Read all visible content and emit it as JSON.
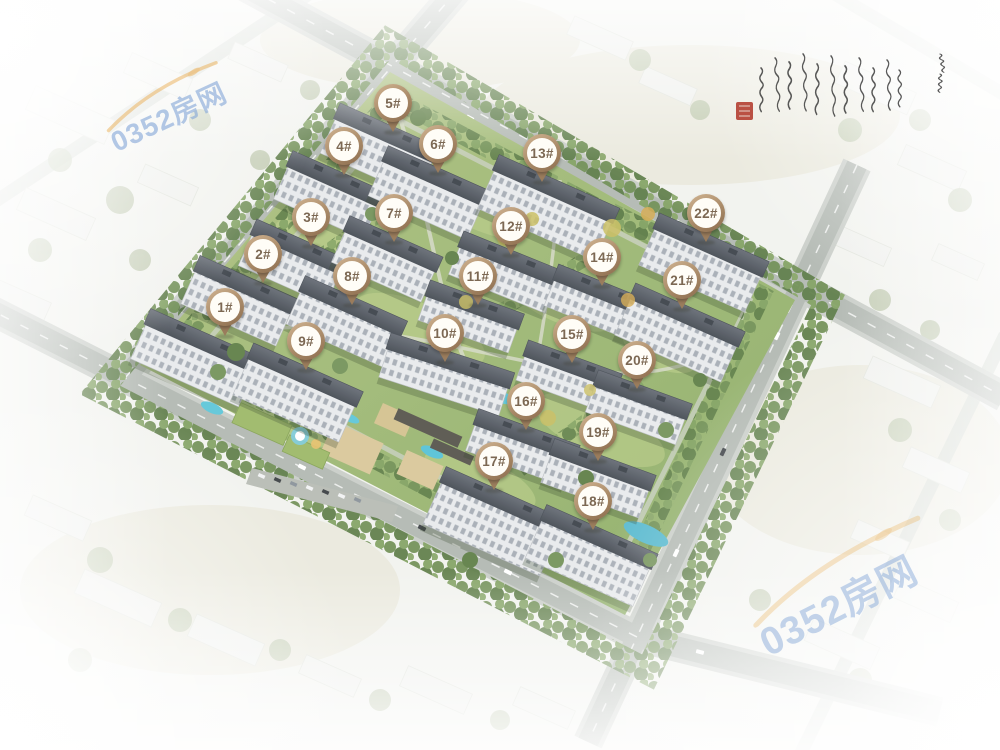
{
  "markers": {
    "items": [
      {
        "label": "1#",
        "x": 225,
        "y": 307
      },
      {
        "label": "2#",
        "x": 263,
        "y": 254
      },
      {
        "label": "3#",
        "x": 311,
        "y": 217
      },
      {
        "label": "4#",
        "x": 344,
        "y": 146
      },
      {
        "label": "5#",
        "x": 393,
        "y": 103
      },
      {
        "label": "6#",
        "x": 438,
        "y": 144
      },
      {
        "label": "7#",
        "x": 394,
        "y": 213
      },
      {
        "label": "8#",
        "x": 352,
        "y": 276
      },
      {
        "label": "9#",
        "x": 306,
        "y": 341
      },
      {
        "label": "10#",
        "x": 445,
        "y": 333
      },
      {
        "label": "11#",
        "x": 478,
        "y": 276
      },
      {
        "label": "12#",
        "x": 511,
        "y": 226
      },
      {
        "label": "13#",
        "x": 542,
        "y": 153
      },
      {
        "label": "14#",
        "x": 602,
        "y": 257
      },
      {
        "label": "15#",
        "x": 572,
        "y": 334
      },
      {
        "label": "16#",
        "x": 526,
        "y": 401
      },
      {
        "label": "17#",
        "x": 494,
        "y": 461
      },
      {
        "label": "18#",
        "x": 593,
        "y": 501
      },
      {
        "label": "19#",
        "x": 598,
        "y": 432
      },
      {
        "label": "20#",
        "x": 637,
        "y": 360
      },
      {
        "label": "21#",
        "x": 682,
        "y": 280
      },
      {
        "label": "22#",
        "x": 706,
        "y": 213
      }
    ],
    "style": {
      "ring_highlight": "#c8ab89",
      "ring_shadow": "#8b6c4e",
      "tail_color": "#9a7c5c",
      "label_color": "#7c6853",
      "fill": "#fffdf7"
    }
  },
  "watermarks": {
    "top_left": {
      "text": "0352房网"
    },
    "bottom_right": {
      "text": "0352房网"
    },
    "text_color": "#7fa3d7",
    "swoosh_color": "#e8a33c"
  },
  "calligraphy": {
    "ink_color": "#353535",
    "seal_color": "#b23a2c"
  },
  "scene_colors": {
    "grass": "#9cb873",
    "tree": "#6d8d52",
    "roof": "#565c64",
    "facade": "#e8eaec",
    "road": "#b2b8b2",
    "water": "#5ec6d8",
    "sand": "#d9c79a",
    "fog": "#ffffff"
  },
  "css_vars": {
    "--wm-blue": "#7fa3d7",
    "--wm-orange": "#e8a33c",
    "--ring-hi": "#c8ab89",
    "--ring-lo": "#8b6c4e",
    "--ring-tail": "#9a7c5c",
    "--label-brown": "#7c6853",
    "--seal-red": "#b23a2c",
    "--ink": "#353535"
  }
}
